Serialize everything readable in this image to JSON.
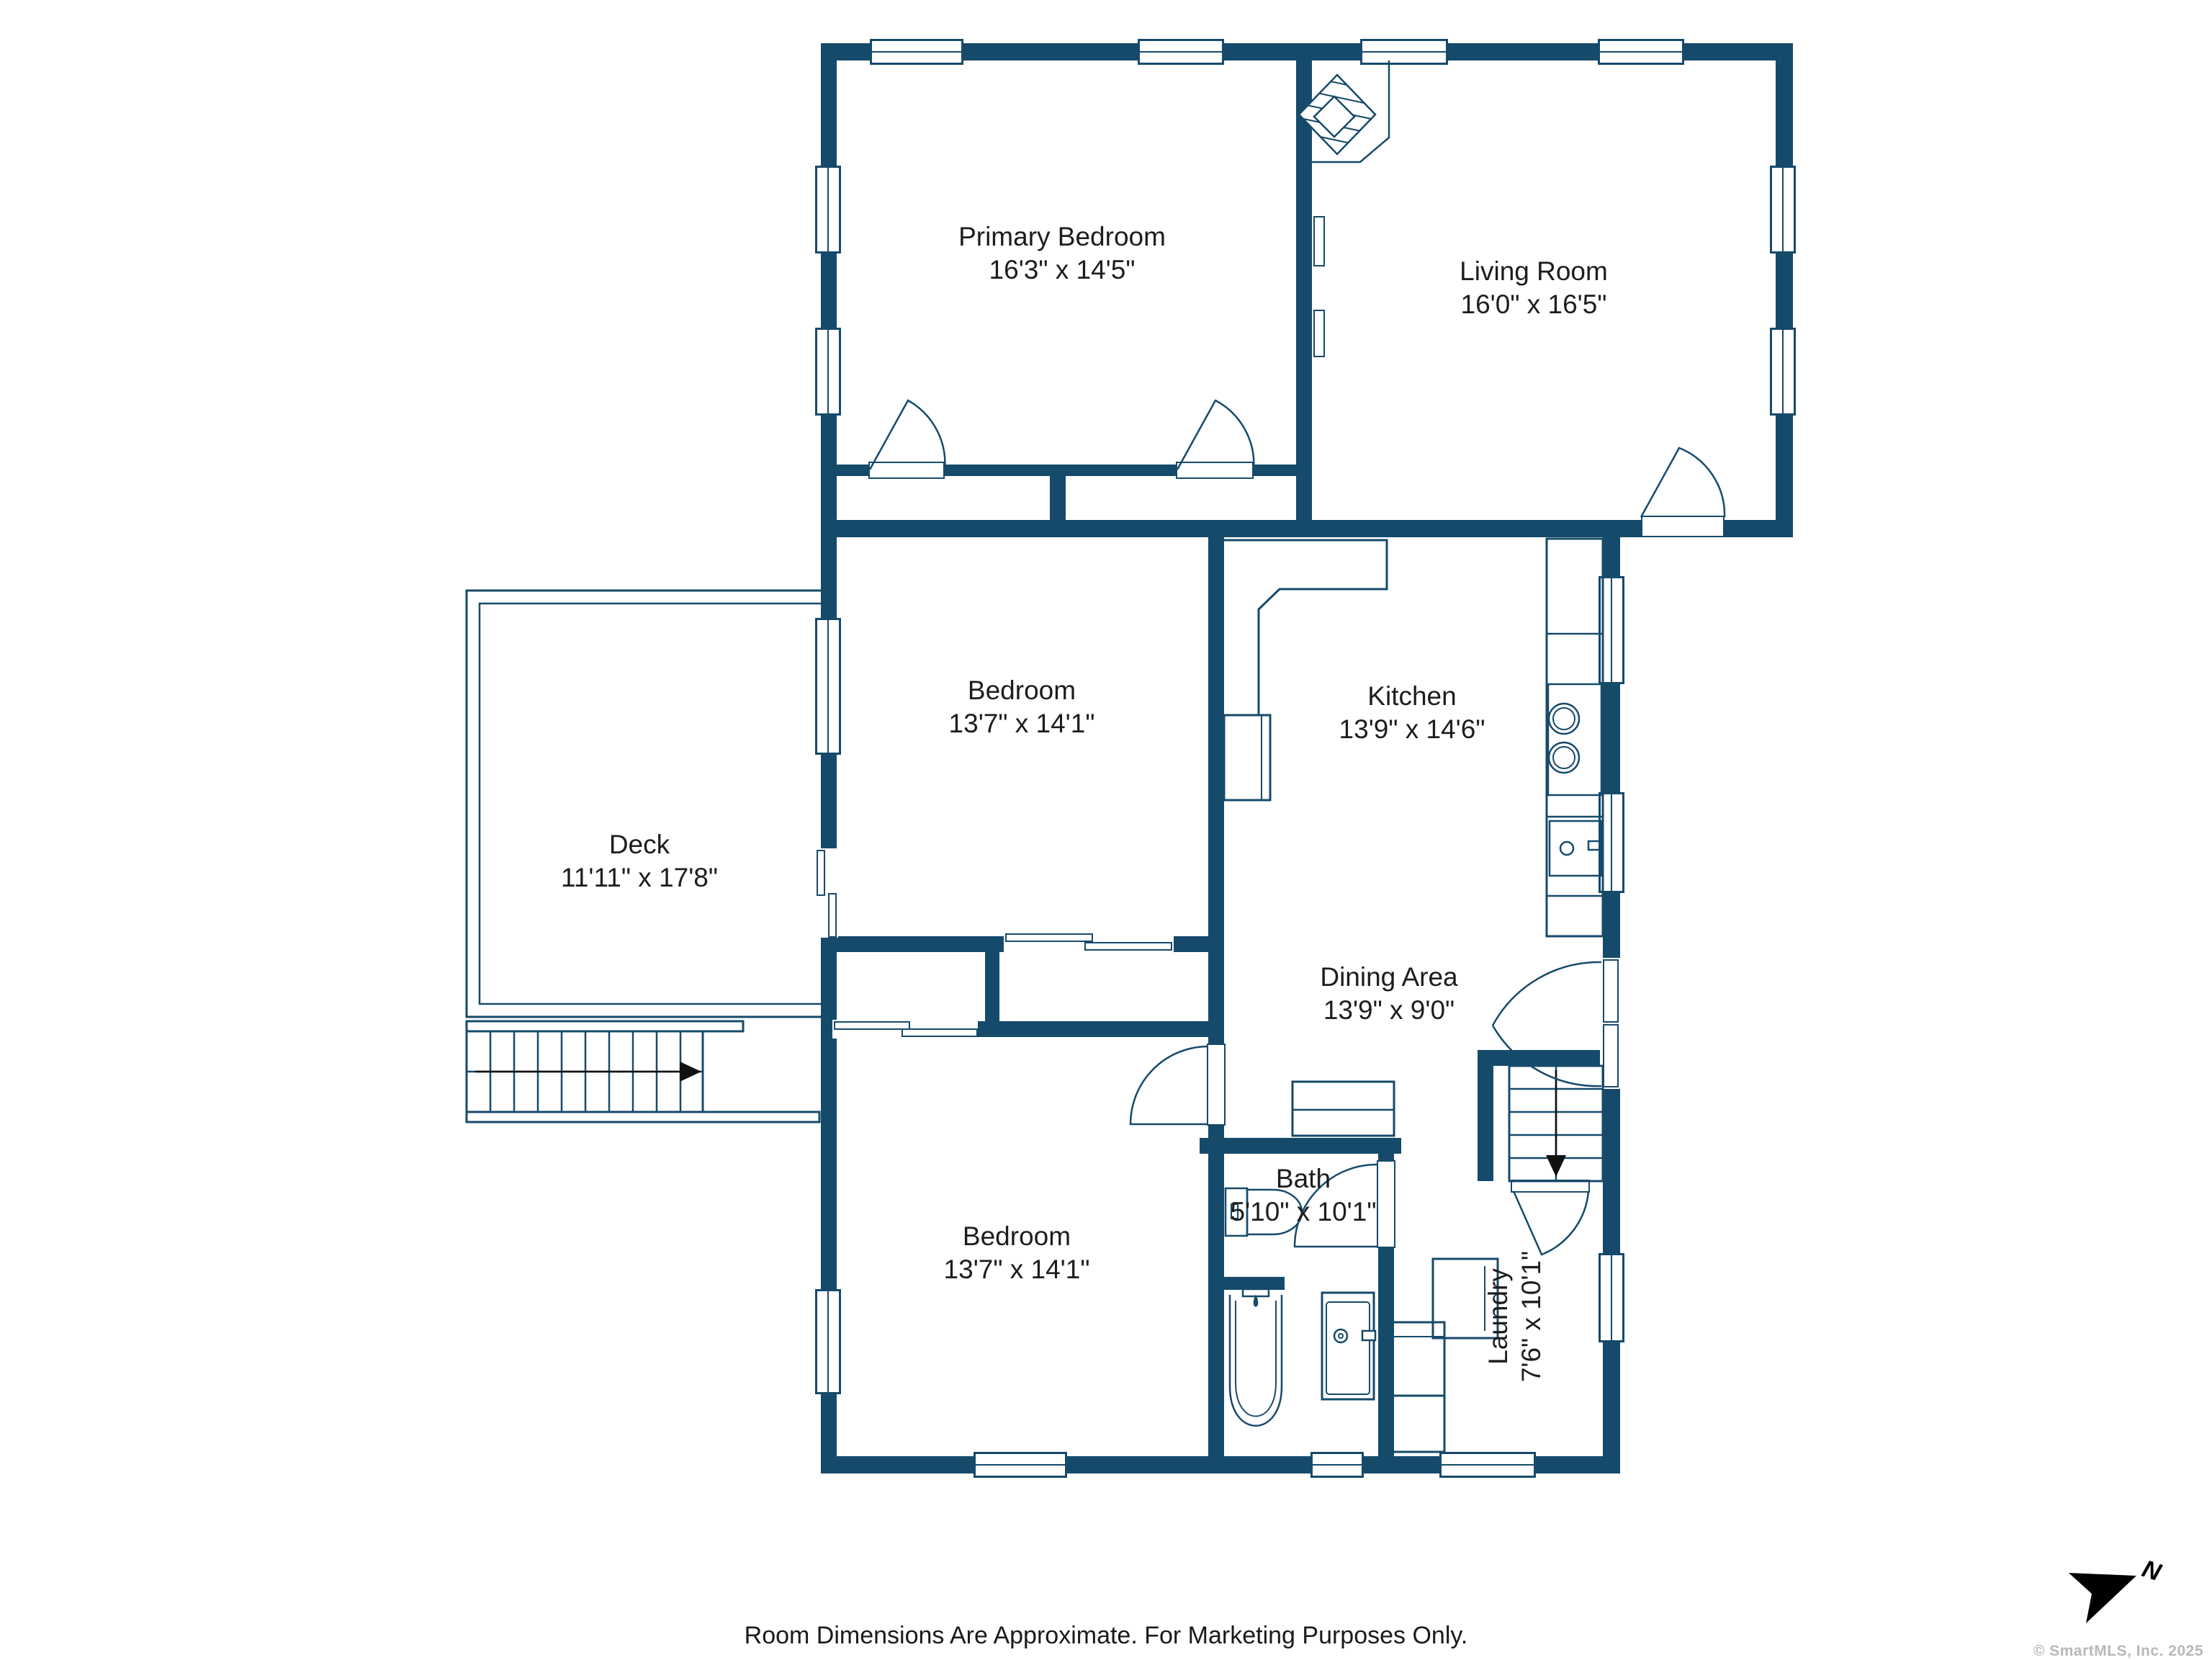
{
  "title": "Floor Plan",
  "rooms": {
    "primary_bedroom": {
      "name": "Primary Bedroom",
      "dims": "16'3\" x 14'5\""
    },
    "living_room": {
      "name": "Living Room",
      "dims": "16'0\" x 16'5\""
    },
    "bedroom_middle": {
      "name": "Bedroom",
      "dims": "13'7\" x 14'1\""
    },
    "kitchen": {
      "name": "Kitchen",
      "dims": "13'9\" x 14'6\""
    },
    "deck": {
      "name": "Deck",
      "dims": "11'11\" x 17'8\""
    },
    "dining_area": {
      "name": "Dining Area",
      "dims": "13'9\" x 9'0\""
    },
    "bath": {
      "name": "Bath",
      "dims": "5'10\" x 10'1\""
    },
    "bedroom_bottom": {
      "name": "Bedroom",
      "dims": "13'7\" x 14'1\""
    },
    "laundry": {
      "name": "Laundry",
      "dims": "7'6\" x 10'1\""
    }
  },
  "compass": {
    "letter": "N"
  },
  "footer": {
    "disclaimer": "Room Dimensions Are Approximate. For Marketing Purposes Only.",
    "copyright": "© SmartMLS, Inc.  2025"
  },
  "colors": {
    "wall": "#164a6b",
    "text": "#1d1d1d",
    "copyright": "#b8b8b8",
    "compass": "#000000"
  }
}
